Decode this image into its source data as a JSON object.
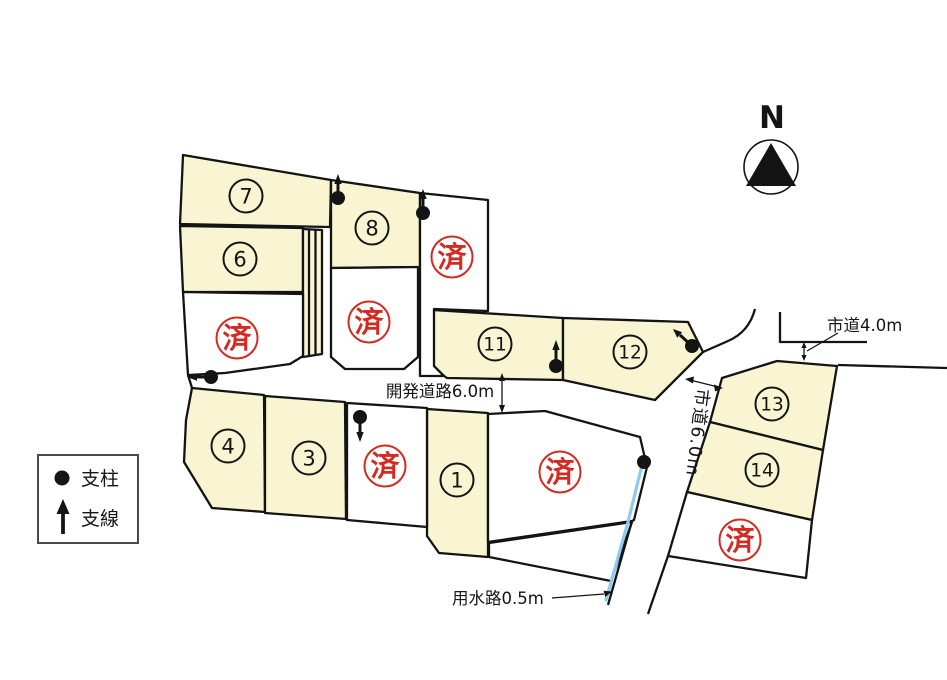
{
  "colors": {
    "lot_fill": "#f9f5d3",
    "outline": "#141414",
    "stamp_red": "#d42a22",
    "water_blue": "#8ecbee"
  },
  "north_label": "N",
  "legend": {
    "pillar": "支柱",
    "guy_wire": "支線"
  },
  "labels": {
    "development_road": "開発道路6.0m",
    "city_road_6": "市道6.0m",
    "city_road_4": "市道4.0m",
    "waterway": "用水路0.5m"
  },
  "sold_stamp": "済",
  "lot_numbers": [
    "7",
    "6",
    "8",
    "11",
    "12",
    "4",
    "3",
    "1",
    "13",
    "14"
  ]
}
